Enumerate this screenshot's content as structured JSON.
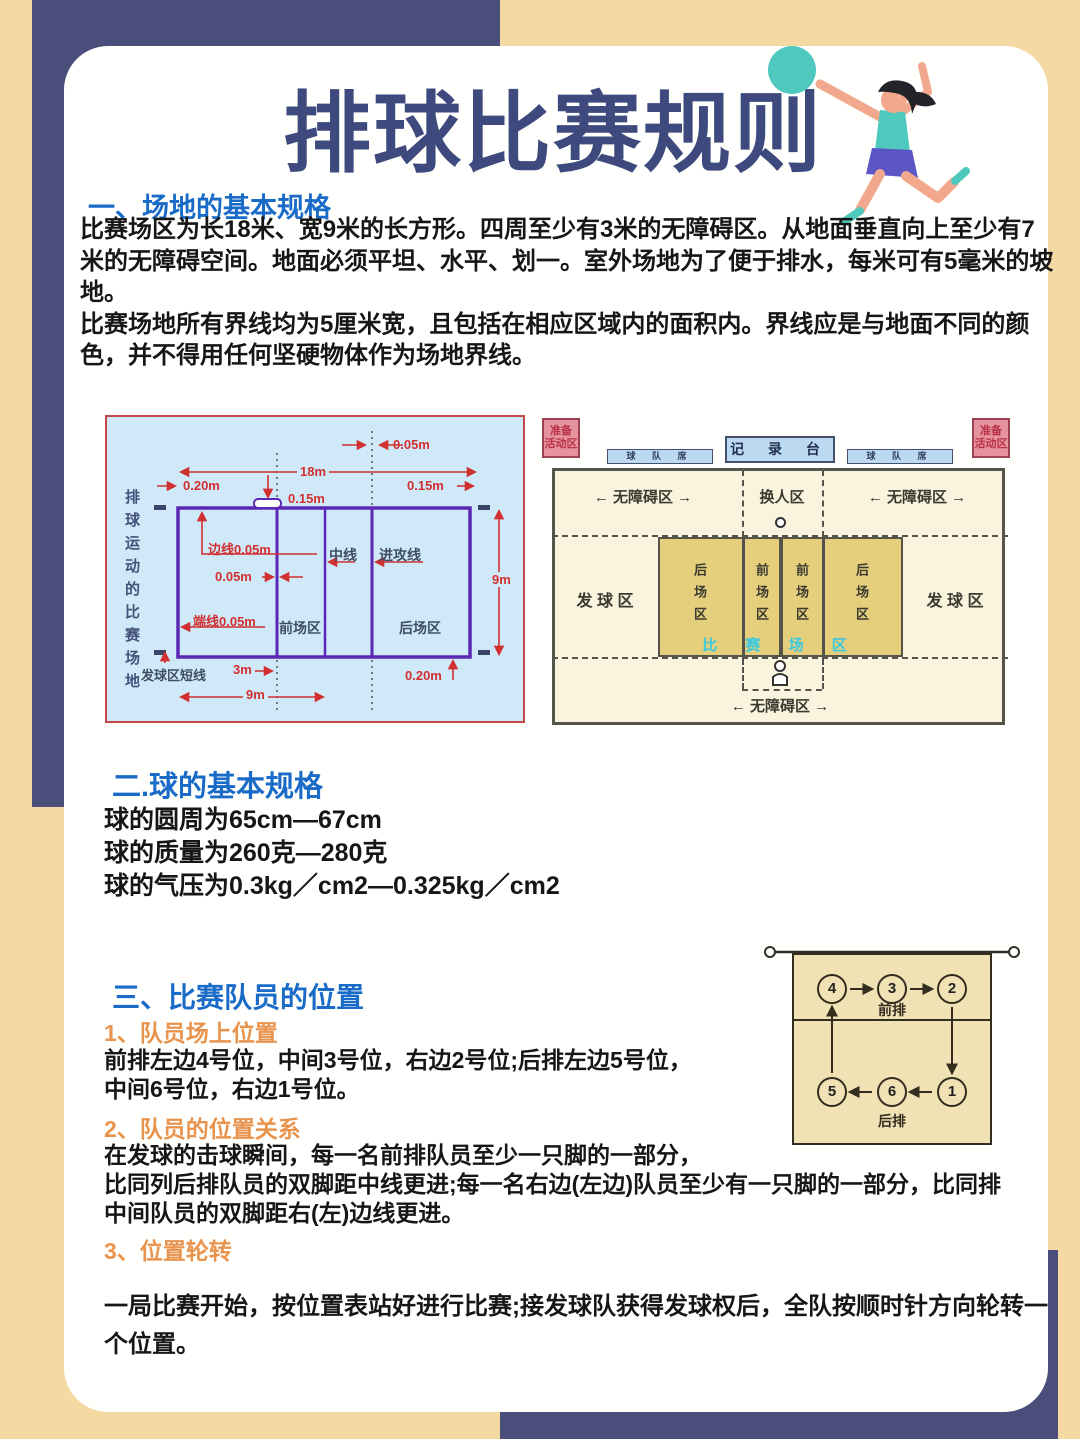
{
  "colors": {
    "page_bg": "#f4d9a2",
    "accent_navy": "#4a4e7a",
    "card_bg": "#fffffe",
    "title_blue": "#3e4a7d",
    "section_blue": "#1a6bc8",
    "sub_orange": "#e8944e",
    "diagram_red": "#d23030",
    "diagram_purple": "#5a28b4",
    "diagram_bg_blue": "#cfe9f8",
    "court_yellow": "#e5cf7d",
    "cyan_text": "#3cc8de"
  },
  "title": "排球比赛规则",
  "illustration": "volleyball-player-spiking",
  "section_field": {
    "heading": "一、场地的基本规格",
    "lines": [
      "比赛场区为长18米、宽9米的长方形。四周至少有3米的无障碍区。从地面垂直向上至少有7",
      "米的无障碍空间。地面必须平坦、水平、划一。室外场地为了便于排水，每米可有5毫米的坡",
      "地。",
      "比赛场地所有界线均为5厘米宽，且包括在相应区域内的面积内。界线应是与地面不同的颜",
      "色，并不得用任何坚硬物体作为场地界线。"
    ]
  },
  "court_diagram": {
    "side_caption": "排球运动的比赛场地",
    "labels": {
      "gap_top": "0.05m",
      "length": "18m",
      "margin_left": "0.20m",
      "net_width": "0.15m",
      "margin_right": "0.15m",
      "sideline": "边线0.05m",
      "line_width": "0.05m",
      "center_line": "中线",
      "attack_line": "进攻线",
      "width": "9m",
      "endline": "端线0.05m",
      "front_zone": "前场区",
      "back_zone": "后场区",
      "service_short_line": "发球区短线",
      "attack_dist": "3m",
      "half_length": "9m",
      "margin_bottom": "0.20m"
    }
  },
  "overview_diagram": {
    "warmup_line1": "准备",
    "warmup_line2": "活动区",
    "team_bench": "球 队 席",
    "scorer_table": "记 录 台",
    "free_zone": "← 无障碍区 →",
    "substitution_zone": "换人区",
    "service_zone": "发 球 区",
    "back_zone": "后场区",
    "front_zone": "前场区",
    "playing_court": "比 赛 场 区"
  },
  "section_ball": {
    "heading": "二.球的基本规格",
    "lines": [
      "球的圆周为65cm—67cm",
      "球的质量为260克—280克",
      "球的气压为0.3kg／cm2—0.325kg／cm2"
    ]
  },
  "section_positions": {
    "heading": "三、比赛队员的位置",
    "sub1_heading": "1、队员场上位置",
    "sub1_lines": [
      "前排左边4号位，中间3号位，右边2号位;后排左边5号位，",
      "中间6号位，右边1号位。"
    ],
    "sub2_heading": "2、队员的位置关系",
    "sub2_lines": [
      "在发球的击球瞬间，每一名前排队员至少一只脚的一部分，",
      "比同列后排队员的双脚距中线更进;每一名右边(左边)队员至少有一只脚的一部分，比同排",
      "中间队员的双脚距右(左)边线更进。"
    ],
    "sub3_heading": "3、位置轮转",
    "sub3_lines": [
      "一局比赛开始，按位置表站好进行比赛;接发球队获得发球权后，全队按顺时针方向轮转一",
      "个位置。"
    ]
  },
  "rotation_diagram": {
    "front_label": "前排",
    "back_label": "后排",
    "front_positions": [
      "4",
      "3",
      "2"
    ],
    "back_positions": [
      "5",
      "6",
      "1"
    ]
  }
}
